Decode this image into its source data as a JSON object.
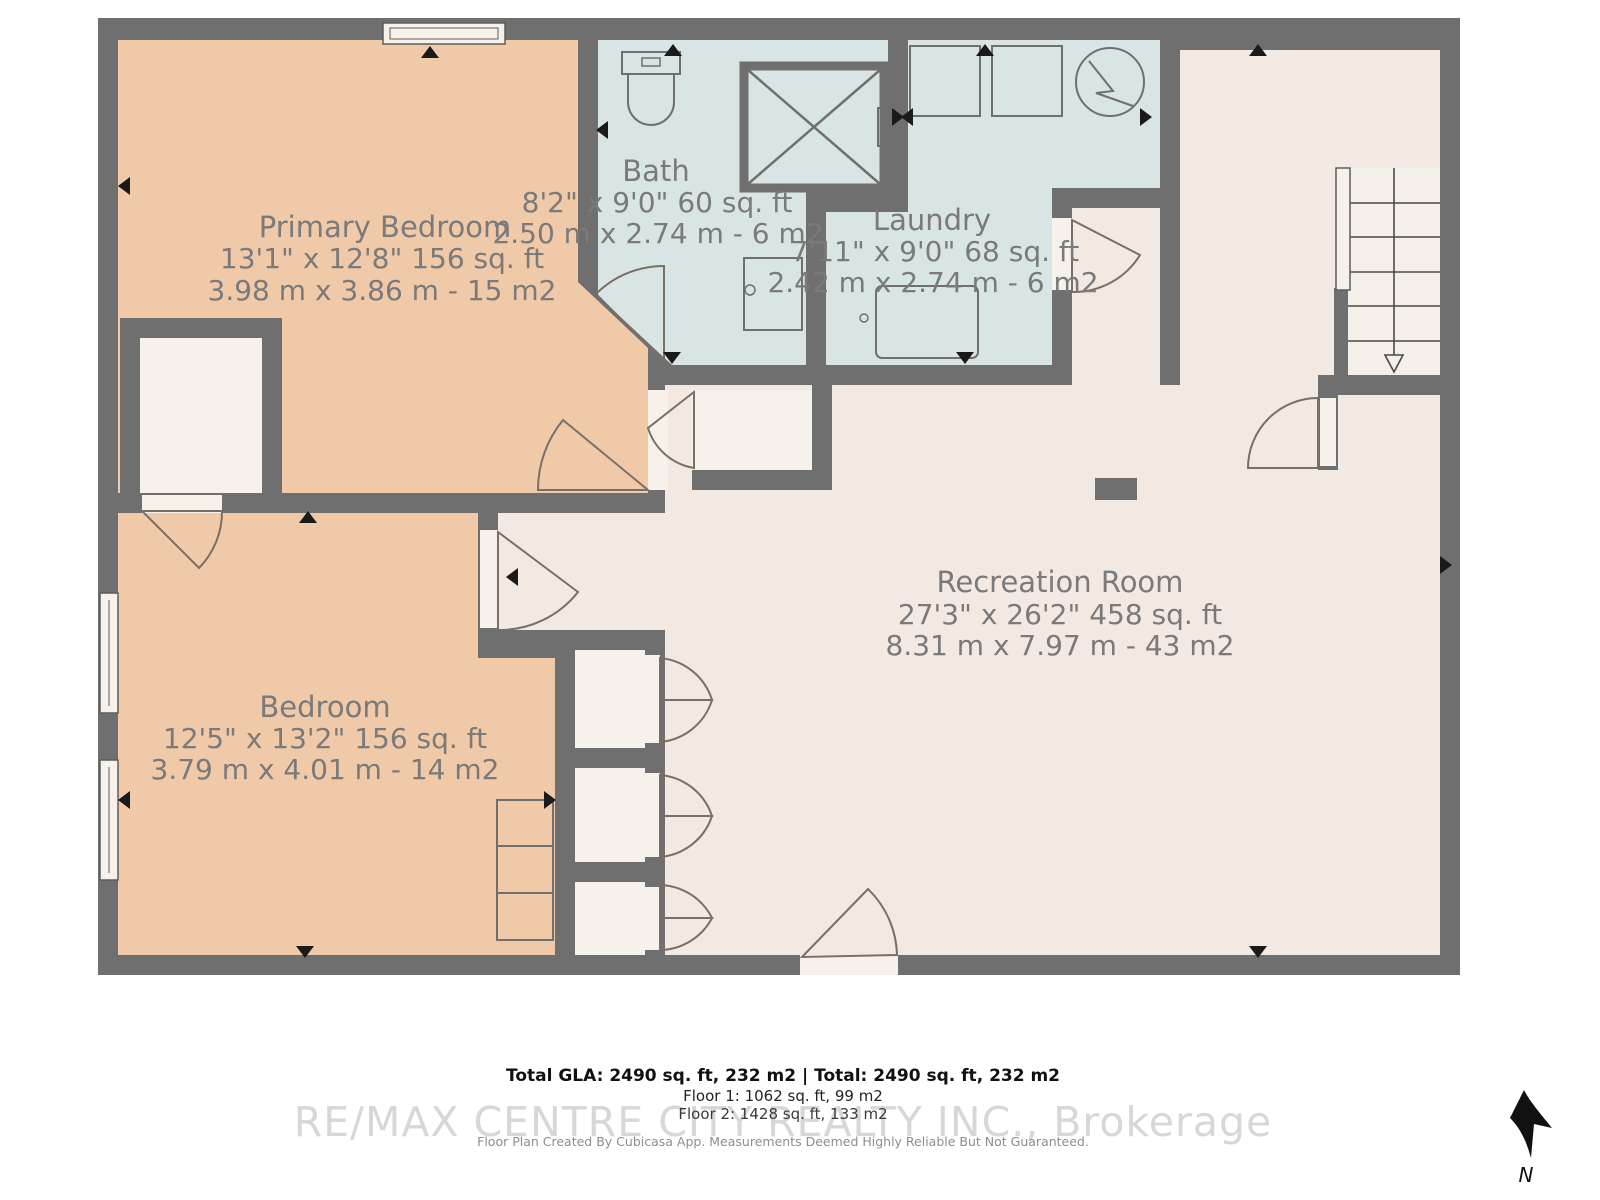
{
  "plan_title": "Basement floor plan",
  "rooms": [
    {
      "id": "primary-bedroom",
      "name": "Primary Bedroom",
      "imperial": "13'1\" x 12'8\" 156 sq. ft",
      "metric": "3.98 m x 3.86 m - 15 m2",
      "fill": "#f0c9a9"
    },
    {
      "id": "bath",
      "name": "Bath",
      "imperial": "8'2\" x 9'0\" 60 sq. ft",
      "metric": "2.50 m x 2.74 m - 6 m2",
      "fill": "#d9e5e4"
    },
    {
      "id": "laundry",
      "name": "Laundry",
      "imperial": "7'11\" x 9'0\" 68 sq. ft",
      "metric": "2.42 m x 2.74 m - 6 m2",
      "fill": "#d9e5e4"
    },
    {
      "id": "recreation-room",
      "name": "Recreation Room",
      "imperial": "27'3\" x 26'2\" 458 sq. ft",
      "metric": "8.31 m x 7.97 m - 43 m2",
      "fill": "#f2e9e3"
    },
    {
      "id": "bedroom",
      "name": "Bedroom",
      "imperial": "12'5\" x 13'2\" 156 sq. ft",
      "metric": "3.79 m x 4.01 m - 14 m2",
      "fill": "#f0c9a9"
    }
  ],
  "footer": {
    "total_line": "Total GLA: 2490 sq. ft, 232 m2 | Total: 2490 sq. ft, 232 m2",
    "floor1_line": "Floor 1: 1062 sq. ft, 99 m2",
    "floor2_line": "Floor 2: 1428 sq. ft, 133 m2",
    "watermark": "RE/MAX CENTRE CITY REALTY INC., Brokerage",
    "credit": "Floor Plan Created By Cubicasa App. Measurements Deemed Highly Reliable But Not Guaranteed."
  },
  "compass": {
    "label": "N"
  },
  "colors": {
    "wall": "#6f6f6f",
    "bedroom_fill": "#f0c9a9",
    "wet_room_fill": "#d9e5e4",
    "living_fill": "#f2e9e3",
    "closet_fill": "#f6f1ea",
    "label_text": "#7a7a7a",
    "marker": "#1a1a1a"
  }
}
